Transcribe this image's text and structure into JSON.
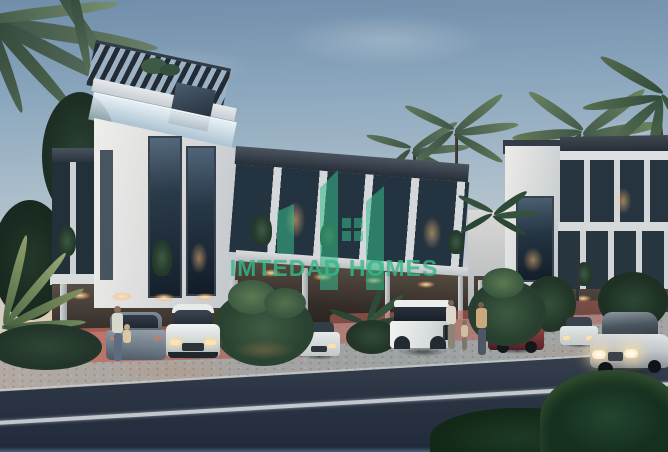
{
  "watermark": {
    "brand": "IMTEDAD HOMES",
    "icon": "buildings-logo-icon"
  },
  "colors": {
    "accent_green": "#34ba8a",
    "sky_top": "#708daa",
    "sky_horizon": "#e2cbaa",
    "facade_light": "#e9e9e6",
    "roof_dark": "#2b333d",
    "road_asphalt": "#2b3544",
    "carport_glow": "#ffd9a0",
    "paver_pink": "#b96a5e",
    "foliage_dark": "#24402e"
  }
}
